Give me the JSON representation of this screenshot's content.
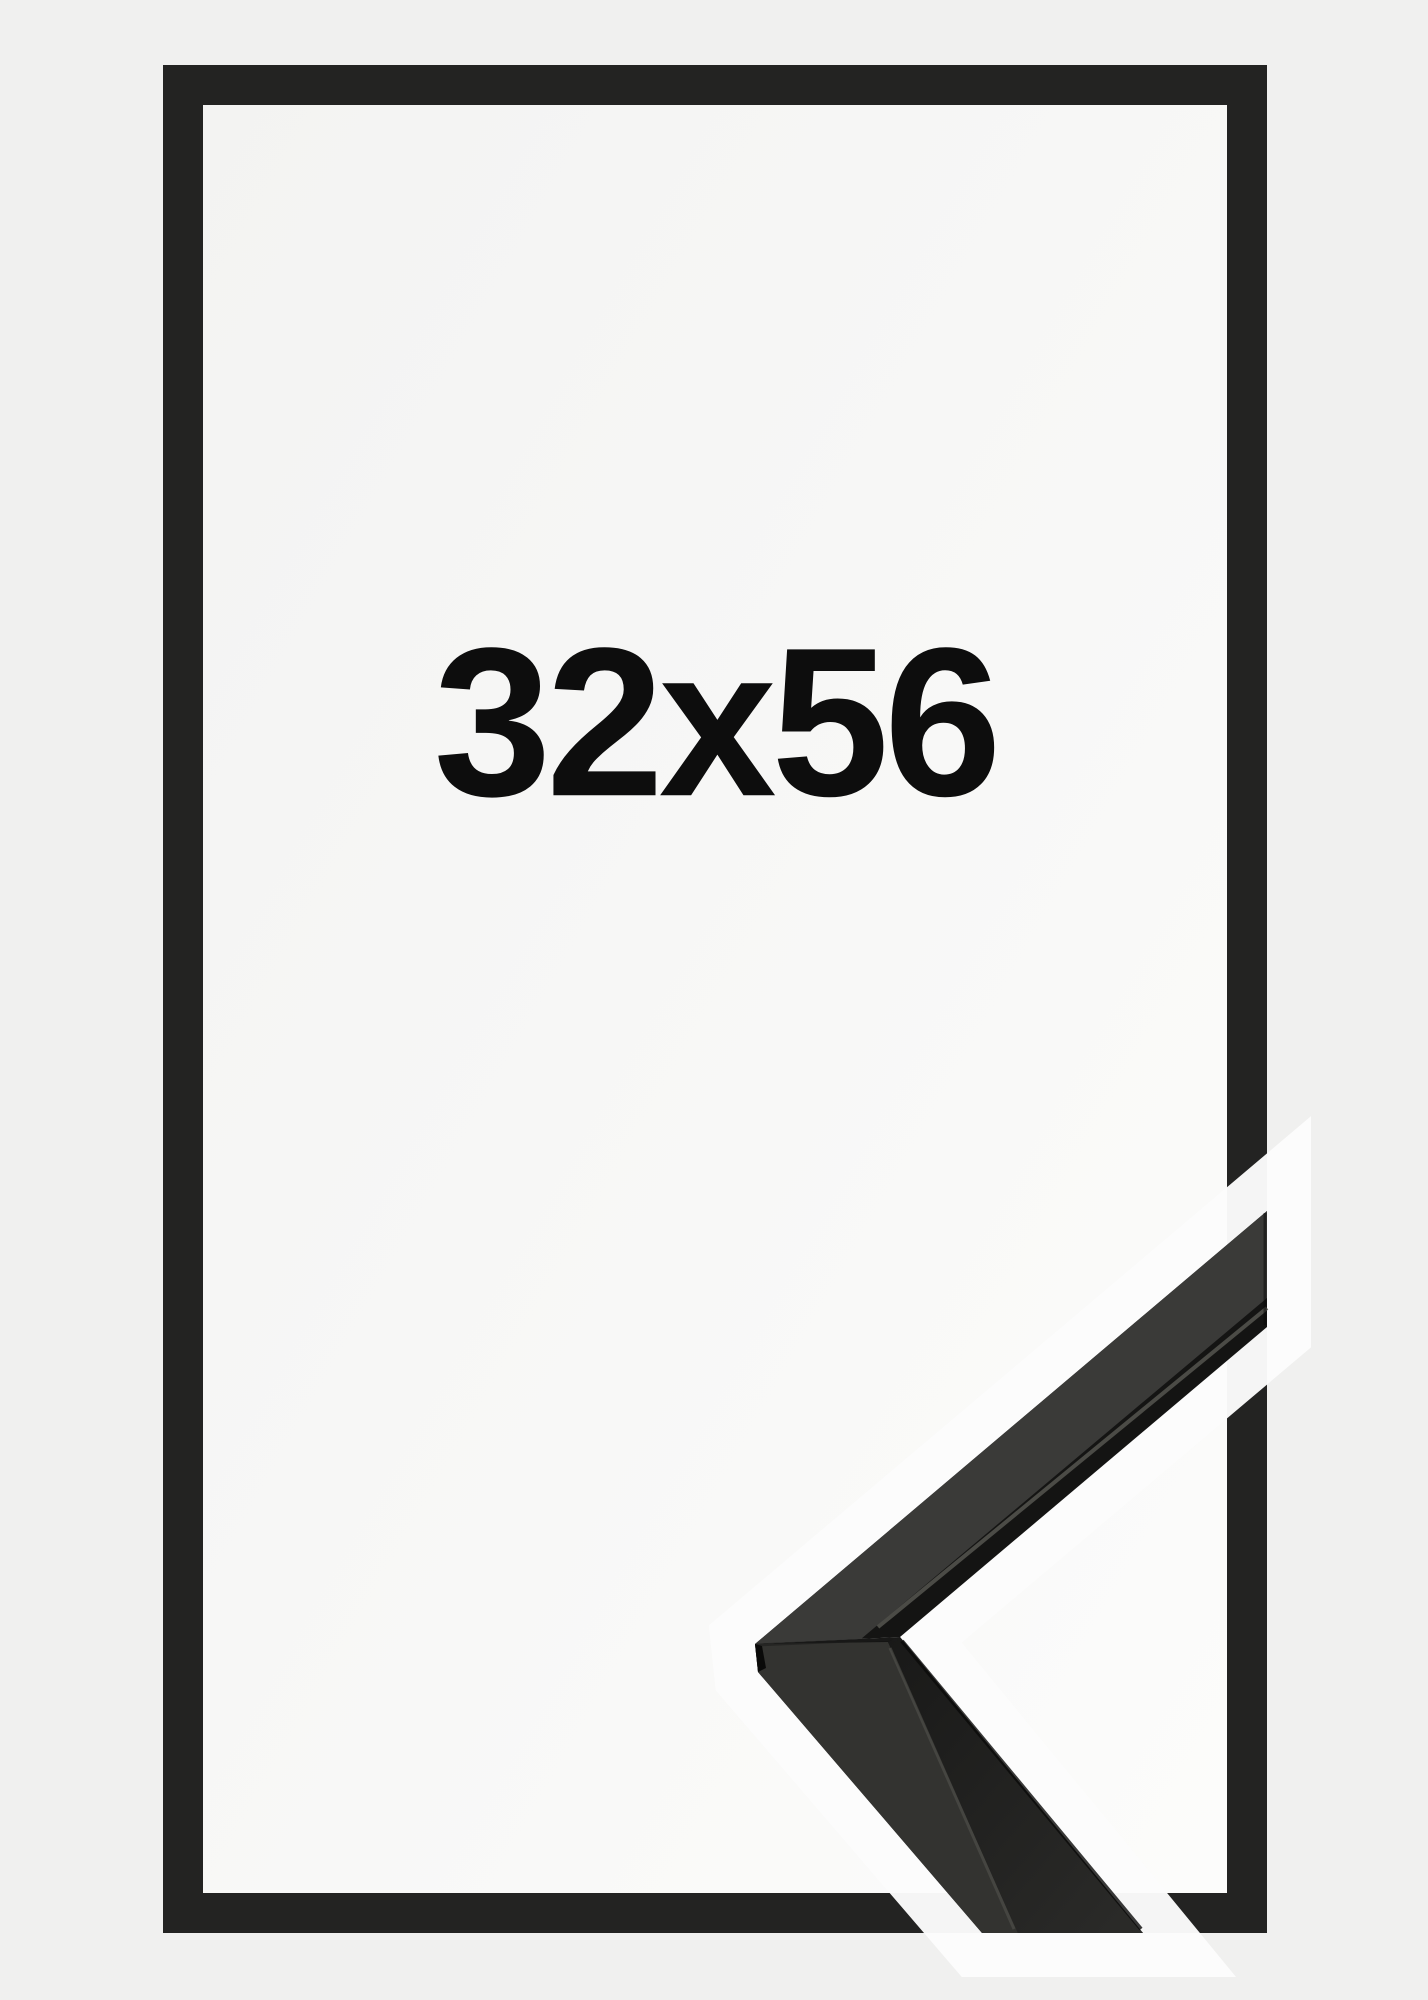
{
  "product": {
    "size_label": "32x56"
  },
  "colors": {
    "bg": "#f0f0ef",
    "interior_a": "#f3f3f2",
    "interior_b": "#fcfcfb",
    "frame": "#232322",
    "halo": "#fcfcfc",
    "text": "#0d0d0d",
    "moulding_top_face": "#3a3a38",
    "moulding_side_strip": "#333330",
    "moulding_dark": "#141413",
    "moulding_face_a": "#191918",
    "moulding_face_b": "#2b2b29",
    "moulding_highlight": "#55554f",
    "moulding_edge_dark": "#0a0a09",
    "moulding_seam": "#1c1c1b"
  }
}
